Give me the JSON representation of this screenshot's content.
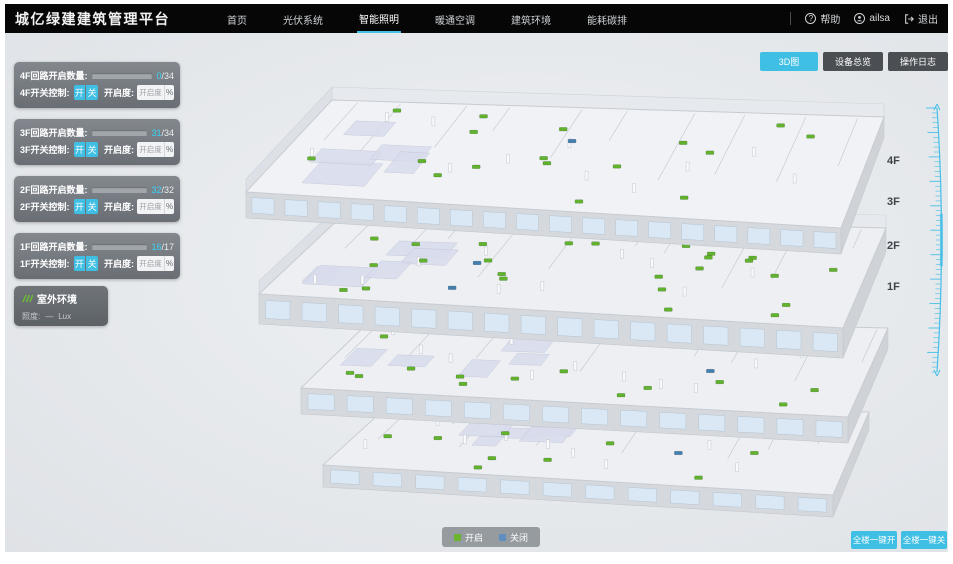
{
  "header": {
    "title": "城亿绿建建筑管理平台",
    "nav": [
      {
        "label": "首页"
      },
      {
        "label": "光伏系统"
      },
      {
        "label": "智能照明"
      },
      {
        "label": "暖通空调"
      },
      {
        "label": "建筑环境"
      },
      {
        "label": "能耗碳排"
      }
    ],
    "help_label": "帮助",
    "user_name": "ailsa",
    "logout_label": "退出",
    "help_icon": "?",
    "active_nav_index": 2
  },
  "toolbar": {
    "view_3d": "3D图",
    "device_overview": "设备总览",
    "operation_log": "操作日志"
  },
  "floor_panels": [
    {
      "circuit_label": "4F回路开启数量:",
      "open": 0,
      "total": 34,
      "open_text": "0",
      "total_text": "/34",
      "switch_label": "4F开关控制:",
      "btn_on": "开",
      "btn_off": "关",
      "dim_label": "开启度:",
      "dim_placeholder": "开启度",
      "percent_label": "%"
    },
    {
      "circuit_label": "3F回路开启数量:",
      "open": 31,
      "total": 34,
      "open_text": "31",
      "total_text": "/34",
      "switch_label": "3F开关控制:",
      "btn_on": "开",
      "btn_off": "关",
      "dim_label": "开启度:",
      "dim_placeholder": "开启度",
      "percent_label": "%"
    },
    {
      "circuit_label": "2F回路开启数量:",
      "open": 32,
      "total": 32,
      "open_text": "32",
      "total_text": "/32",
      "switch_label": "2F开关控制:",
      "btn_on": "开",
      "btn_off": "关",
      "dim_label": "开启度:",
      "dim_placeholder": "开启度",
      "percent_label": "%"
    },
    {
      "circuit_label": "1F回路开启数量:",
      "open": 16,
      "total": 17,
      "open_text": "16",
      "total_text": "/17",
      "switch_label": "1F开关控制:",
      "btn_on": "开",
      "btn_off": "关",
      "dim_label": "开启度:",
      "dim_placeholder": "开启度",
      "percent_label": "%"
    }
  ],
  "outdoor_panel": {
    "title": "室外环境",
    "illuminance_label": "照度:",
    "value": "—",
    "unit": "Lux"
  },
  "floor_scale": {
    "labels": [
      "4F",
      "3F",
      "2F",
      "1F"
    ]
  },
  "legend": {
    "on_label": "开启",
    "off_label": "关闭",
    "on_color": "#6cb52e",
    "off_color": "#5e8fc0"
  },
  "bottom_actions": {
    "all_on": "全楼一键开",
    "all_off": "全楼一键关"
  },
  "building": {
    "floors": [
      {
        "name": "4F",
        "green_markers": 17,
        "blue_markers": 1
      },
      {
        "name": "3F",
        "green_markers": 27,
        "blue_markers": 2
      },
      {
        "name": "2F",
        "green_markers": 16,
        "blue_markers": 1
      },
      {
        "name": "1F",
        "green_markers": 11,
        "blue_markers": 1
      }
    ]
  },
  "colors": {
    "accent": "#3fbfe3",
    "marker_green": "#61b32e",
    "marker_blue": "#4380b0",
    "ruler": "#45bfe8"
  }
}
